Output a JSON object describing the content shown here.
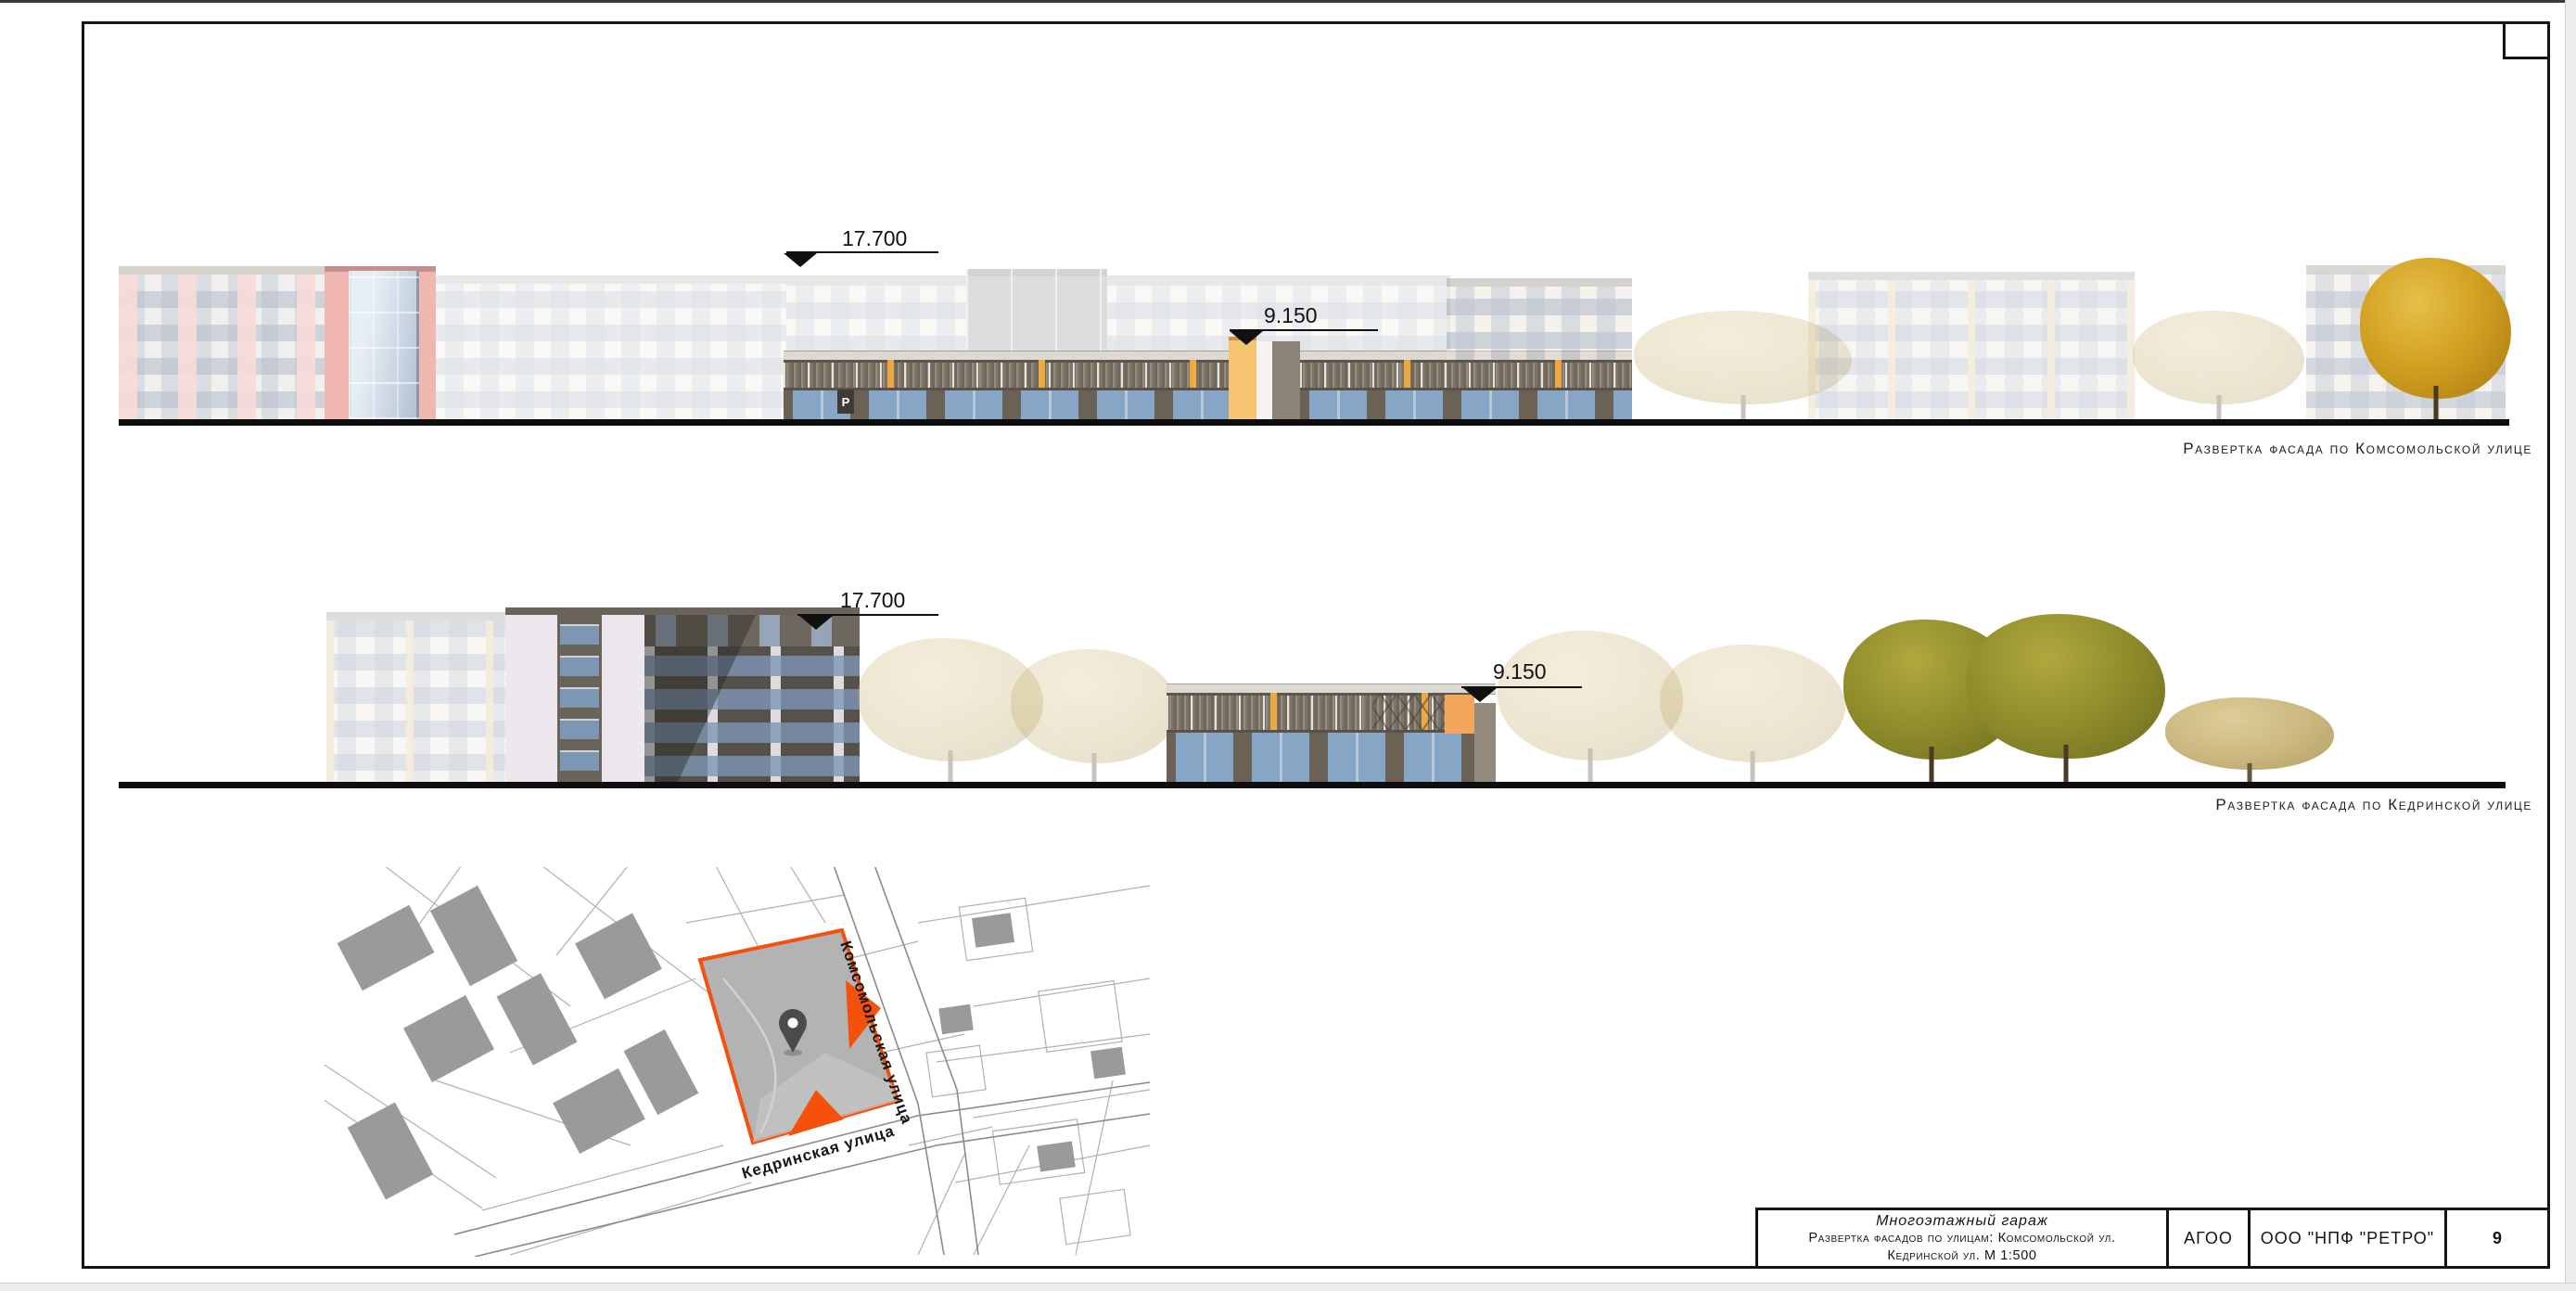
{
  "page": {
    "captions": {
      "elevation1": "Развертка фасада по Комсомольской улице",
      "elevation2": "Развертка фасада по Кедринской улице"
    },
    "marks": {
      "e1_top": "17.700",
      "e1_mid": "9.150",
      "e2_top": "17.700",
      "e2_mid": "9.150"
    },
    "garage_sign": "P",
    "map": {
      "street1": "Комсомольская улица",
      "street2": "Кедринская улица"
    },
    "title_block": {
      "project": "Многоэтажный гараж",
      "subtitle1": "Развертка фасадов по улицам: Комсомольской ул.",
      "subtitle2": "Кедринской ул. М 1:500",
      "author": "АГОО",
      "organization": "ООО \"НПФ \"РЕТРО\"",
      "sheet_number": "9"
    },
    "colors": {
      "accent_orange": "#f4510c",
      "parcel_gray": "#b3b3b3",
      "line_black": "#111111"
    }
  }
}
